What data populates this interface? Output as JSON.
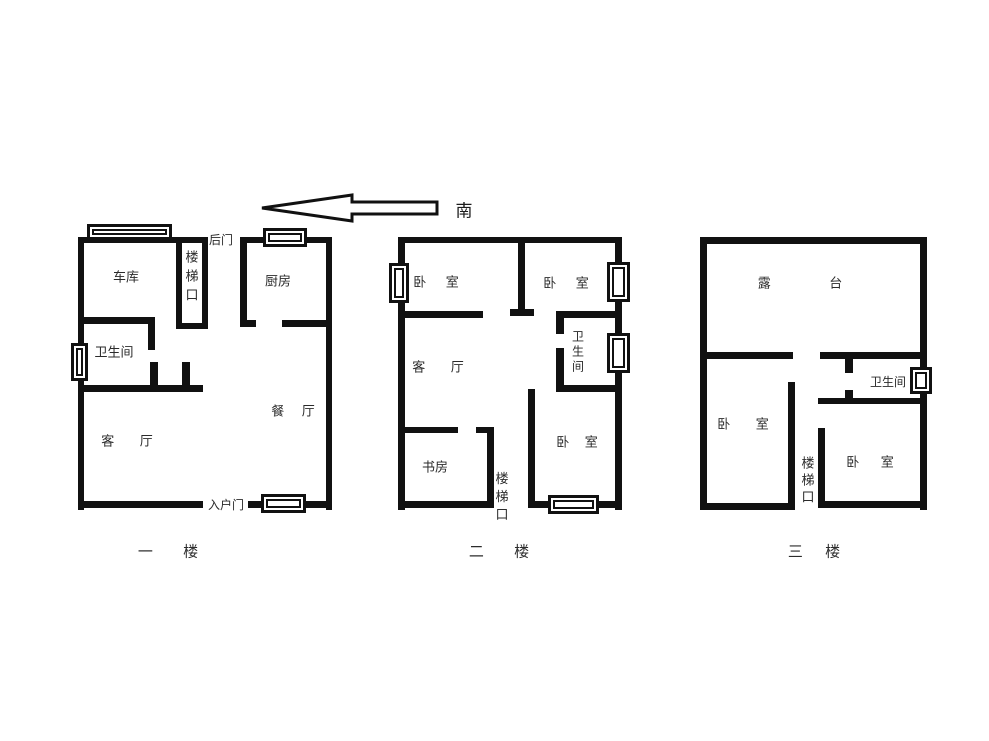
{
  "colors": {
    "wall": "#111111",
    "text": "#2b2b2b",
    "background": "#ffffff"
  },
  "compass": {
    "label": "南",
    "label_pos": {
      "x": 464,
      "y": 209
    },
    "arrow_points": "262,208 352,195 352,202 437,202 437,214 352,214 352,221",
    "direction": "left"
  },
  "floors": [
    {
      "id": "floor-1",
      "label": "一 楼",
      "label_pos": {
        "x": 168,
        "y": 551
      },
      "label_word_spacing": 26,
      "walls": [
        [
          78,
          237,
          130,
          6
        ],
        [
          240,
          237,
          92,
          6
        ],
        [
          78,
          237,
          6,
          273
        ],
        [
          326,
          237,
          6,
          273
        ],
        [
          176,
          243,
          6,
          86
        ],
        [
          202,
          243,
          6,
          86
        ],
        [
          176,
          323,
          32,
          6
        ],
        [
          78,
          317,
          77,
          7
        ],
        [
          148,
          317,
          7,
          33
        ],
        [
          78,
          385,
          125,
          7
        ],
        [
          150,
          362,
          8,
          23
        ],
        [
          182,
          362,
          8,
          30
        ],
        [
          240,
          243,
          7,
          84
        ],
        [
          240,
          320,
          16,
          7
        ],
        [
          282,
          320,
          50,
          7
        ],
        [
          78,
          501,
          125,
          7
        ],
        [
          248,
          501,
          17,
          7
        ],
        [
          303,
          501,
          29,
          7
        ]
      ],
      "windows": [
        [
          87,
          224,
          85,
          16
        ],
        [
          263,
          228,
          44,
          19
        ],
        [
          71,
          343,
          17,
          38
        ],
        [
          261,
          494,
          45,
          19
        ]
      ],
      "labels": [
        {
          "text": "车库",
          "x": 126,
          "y": 277,
          "sp": 4
        },
        {
          "text": "楼梯口",
          "x": 192,
          "y": 276,
          "vertical": true,
          "lh": 19
        },
        {
          "text": "后门",
          "x": 221,
          "y": 240,
          "fs": 12
        },
        {
          "text": "厨房",
          "x": 278,
          "y": 281
        },
        {
          "text": "卫生间",
          "x": 114,
          "y": 352
        },
        {
          "text": "客 厅",
          "x": 127,
          "y": 441,
          "sp": 22
        },
        {
          "text": "餐 厅",
          "x": 293,
          "y": 411,
          "sp": 14
        },
        {
          "text": "入户门",
          "x": 226,
          "y": 505,
          "fs": 12
        }
      ]
    },
    {
      "id": "floor-2",
      "label": "二 楼",
      "label_pos": {
        "x": 499,
        "y": 551
      },
      "label_word_spacing": 26,
      "walls": [
        [
          398,
          237,
          224,
          6
        ],
        [
          398,
          237,
          7,
          273
        ],
        [
          615,
          237,
          7,
          273
        ],
        [
          518,
          243,
          7,
          72
        ],
        [
          510,
          309,
          24,
          7
        ],
        [
          398,
          311,
          85,
          7
        ],
        [
          556,
          311,
          62,
          7
        ],
        [
          556,
          318,
          8,
          16
        ],
        [
          556,
          348,
          8,
          42
        ],
        [
          556,
          385,
          62,
          7
        ],
        [
          528,
          389,
          7,
          119
        ],
        [
          398,
          427,
          60,
          6
        ],
        [
          476,
          427,
          18,
          6
        ],
        [
          487,
          427,
          7,
          81
        ],
        [
          398,
          501,
          96,
          7
        ],
        [
          528,
          501,
          94,
          7
        ]
      ],
      "windows": [
        [
          389,
          263,
          20,
          40
        ],
        [
          607,
          262,
          23,
          40
        ],
        [
          607,
          333,
          23,
          40
        ],
        [
          548,
          495,
          51,
          19
        ]
      ],
      "labels": [
        {
          "text": "卧 室",
          "x": 436,
          "y": 282,
          "sp": 16
        },
        {
          "text": "卧 室",
          "x": 566,
          "y": 283,
          "sp": 16
        },
        {
          "text": "卫生间",
          "x": 578,
          "y": 352,
          "vertical": true,
          "lh": 15,
          "fs": 12
        },
        {
          "text": "客 厅",
          "x": 438,
          "y": 367,
          "sp": 22
        },
        {
          "text": "书房",
          "x": 435,
          "y": 467
        },
        {
          "text": "楼梯口",
          "x": 502,
          "y": 497,
          "vertical": true,
          "lh": 18
        },
        {
          "text": "卧 室",
          "x": 577,
          "y": 442,
          "sp": 12
        }
      ]
    },
    {
      "id": "floor-3",
      "label": "三 楼",
      "label_pos": {
        "x": 814,
        "y": 551
      },
      "label_word_spacing": 18,
      "walls": [
        [
          700,
          237,
          227,
          7
        ],
        [
          700,
          237,
          7,
          273
        ],
        [
          920,
          237,
          7,
          273
        ],
        [
          700,
          352,
          93,
          7
        ],
        [
          820,
          352,
          107,
          7
        ],
        [
          788,
          382,
          7,
          128
        ],
        [
          700,
          503,
          95,
          7
        ],
        [
          845,
          359,
          8,
          14
        ],
        [
          845,
          390,
          8,
          14
        ],
        [
          818,
          398,
          109,
          6
        ],
        [
          818,
          428,
          7,
          80
        ],
        [
          818,
          501,
          109,
          7
        ]
      ],
      "windows": [
        [
          910,
          367,
          22,
          27
        ]
      ],
      "labels": [
        {
          "text": "露 台",
          "x": 800,
          "y": 283,
          "sp": 55
        },
        {
          "text": "卫生间",
          "x": 888,
          "y": 382,
          "fs": 12
        },
        {
          "text": "卧 室",
          "x": 743,
          "y": 424,
          "sp": 22
        },
        {
          "text": "楼梯口",
          "x": 808,
          "y": 480,
          "vertical": true,
          "lh": 17
        },
        {
          "text": "卧 室",
          "x": 870,
          "y": 462,
          "sp": 18
        }
      ]
    }
  ]
}
